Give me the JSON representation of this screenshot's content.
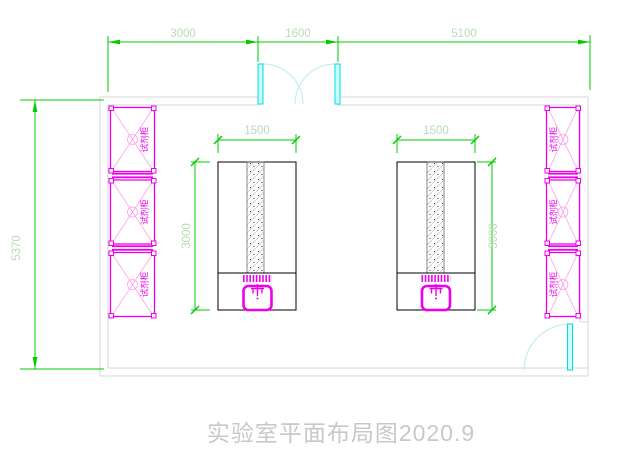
{
  "drawing": {
    "title": "实验室平面布局图2020.9",
    "dimensions": {
      "top": {
        "seg1": "3000",
        "seg2": "1600",
        "seg3": "5100"
      },
      "left_wall": "5370",
      "bench_width": "1500",
      "bench_depth": "3000"
    },
    "cabinet_label": "试剂柜",
    "colors": {
      "dimension_green": "#00cc00",
      "dimension_text_green": "#b5ddb5",
      "wall_gray": "#d6d6d6",
      "cabinet_magenta": "#ee00ee",
      "door_cyan": "#00dddd",
      "bench_outline": "#000000",
      "title_gray": "#c8c8c8"
    }
  }
}
